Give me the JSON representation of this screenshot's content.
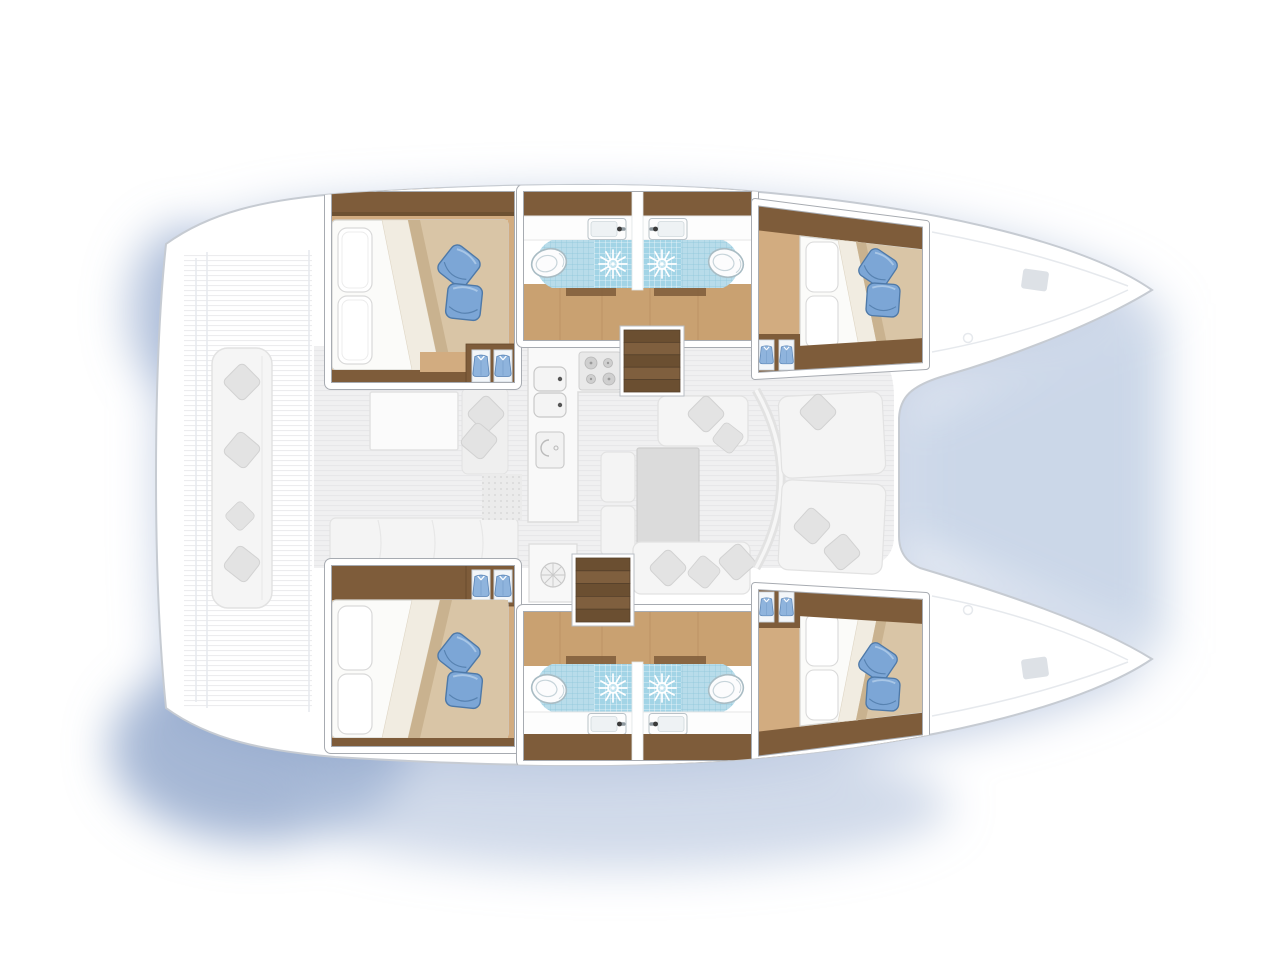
{
  "page": {
    "title": "Catamaran yacht interior floor plan, top-down view, bow to the right"
  },
  "colors": {
    "bg": "#ffffff",
    "hull_fill": "#ffffff",
    "hull_stroke": "#c6cbd2",
    "deck_line": "#e6e9ed",
    "salon_floor": "#f0f0f1",
    "salon_stripe": "#e6e6e8",
    "furn_fill": "#f5f5f5",
    "furn_stroke": "#e2e2e2",
    "pillow_gray": "#e3e3e3",
    "pillow_gray_stroke": "#d2d2d2",
    "table_gray": "#dbdbdb",
    "wood_light": "#d2ac80",
    "wood_mid": "#c9a171",
    "wood_plank": "#b88f61",
    "wood_dark": "#7e5c3a",
    "wood_dark_edge": "#64492c",
    "step_a": "#6b4f31",
    "step_b": "#7f5f3e",
    "mattress": "#fbfbf9",
    "mattress_stroke": "#d6d6d2",
    "duvet": "#d9c5a6",
    "duvet_shadow": "#c9b28f",
    "duvet_fold": "#f1ece1",
    "pillow_blue": "#7ca6d6",
    "pillow_blue_dark": "#4e79a8",
    "pillow_blue_light": "#a8c6e6",
    "tile": "#b8dcea",
    "tile_grid": "#8ec6da",
    "shower": "#a2d4e6",
    "porcelain": "#fcfcfd",
    "porcelain_stroke": "#a9bcc4",
    "counter": "#fdfdfd",
    "basin": "#eef2f4",
    "faucet": "#3a3a3a",
    "locker": "#f3f6f9",
    "locker_stroke": "#ccd6df",
    "shirt": "#8fb4dd",
    "shirt_dark": "#5d87b8",
    "card_outline": "#a7abb1",
    "shadow_main": "#b3c1dc",
    "shadow_dark": "#8fa5cb",
    "shadow_mid": "#a9bcd9"
  },
  "vessel": {
    "type": "catamaran",
    "view": "top-down deck / accommodation plan",
    "orientation": "bows pointing right, stern at left",
    "hulls": [
      {
        "side": "port (top hull)",
        "rooms": [
          {
            "name": "aft double cabin",
            "features": [
              "double bed",
              "2 white pillows",
              "2 blue pillows",
              "beige duvet folded back",
              "wardrobe with hanging clothes"
            ]
          },
          {
            "name": "aft bathroom",
            "fixtures": [
              "toilet",
              "washbasin with faucet",
              "shower with starburst drain"
            ]
          },
          {
            "name": "forward bathroom",
            "fixtures": [
              "shower with starburst drain",
              "washbasin with faucet",
              "toilet"
            ]
          },
          {
            "name": "forward double cabin",
            "features": [
              "double bed",
              "2 white pillows",
              "2 blue pillows",
              "beige duvet folded back",
              "wardrobe with hanging clothes"
            ]
          }
        ]
      },
      {
        "side": "starboard (bottom hull)",
        "rooms": [
          {
            "name": "aft double cabin",
            "features": [
              "double bed",
              "2 white pillows",
              "2 blue pillows",
              "beige duvet folded back",
              "wardrobe with hanging clothes"
            ]
          },
          {
            "name": "aft bathroom",
            "fixtures": [
              "toilet",
              "washbasin with faucet",
              "shower with starburst drain"
            ]
          },
          {
            "name": "forward bathroom",
            "fixtures": [
              "shower with starburst drain",
              "washbasin with faucet",
              "toilet"
            ]
          },
          {
            "name": "forward double cabin",
            "features": [
              "double bed",
              "2 white pillows",
              "2 blue pillows",
              "beige duvet folded back",
              "wardrobe with hanging clothes"
            ]
          }
        ]
      }
    ],
    "bridgedeck": {
      "salon": [
        "galley with 4-burner stove",
        "double sink",
        "appliance unit",
        "dinette table",
        "U-shaped seating with cushions",
        "forward facing seats behind curved coachroof front",
        "aft settee"
      ],
      "cockpit": [
        "long bench with 4 cushions",
        "cockpit table",
        "side seat with 2 cushions"
      ],
      "companionways": [
        "port hull stairs (5 steps)",
        "starboard hull stairs (5 steps)"
      ]
    },
    "counts": {
      "cabins": 4,
      "bathrooms": 4,
      "toilets": 4,
      "showers": 4,
      "washbasins": 4,
      "stairs": 2
    }
  },
  "legend_icons": [
    "sun-drain-icon",
    "toilet-icon",
    "washbasin-icon",
    "hanging-shirt-icon",
    "blue-pillow-icon",
    "gray-cushion-icon",
    "stairs-icon"
  ]
}
